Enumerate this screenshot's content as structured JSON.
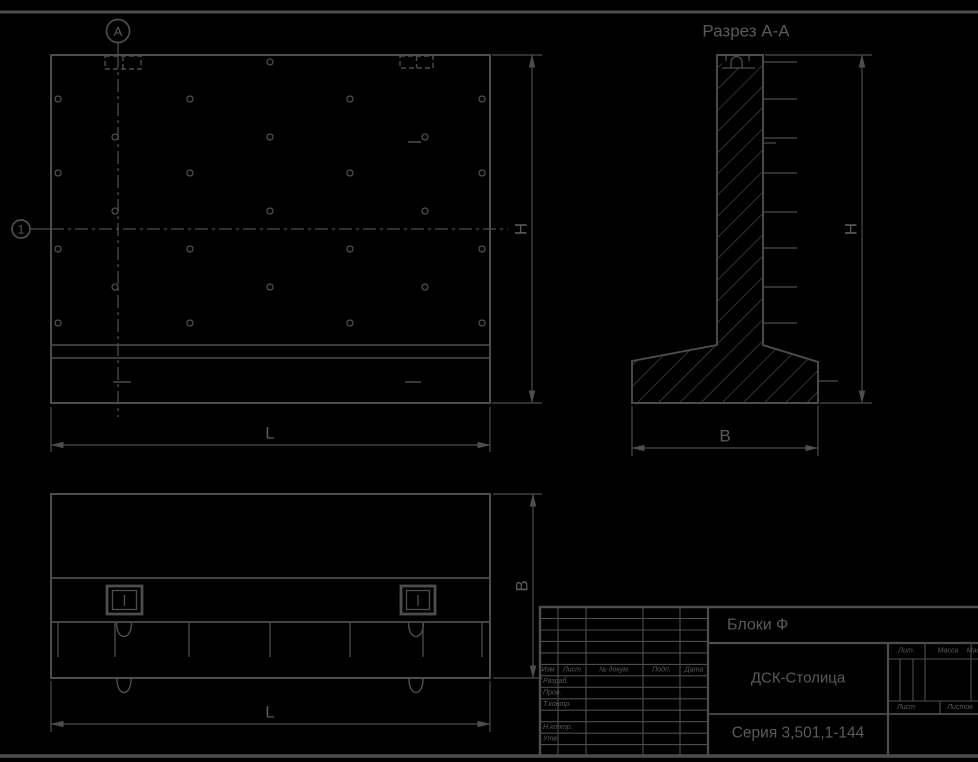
{
  "colors": {
    "background": "#000000",
    "line": "#4d4d4d",
    "text": "#5a5a5a"
  },
  "views": {
    "front": {
      "axis_marker_top": "А",
      "axis_marker_left": "1",
      "dim_length": "L",
      "dim_height": "H"
    },
    "section": {
      "title": "Разрез А-А",
      "dim_height": "H",
      "dim_width": "B"
    },
    "plan": {
      "dim_length": "L",
      "dim_width": "B"
    }
  },
  "title_block": {
    "doc_title": "Блоки Ф",
    "organization": "ДСК-Столица",
    "series": "Серия 3,501,1-144",
    "header_cols": [
      "Изм.",
      "Лист",
      "№ докум.",
      "Подп.",
      "Дата"
    ],
    "row_labels": [
      "Разраб.",
      "Пров.",
      "Т.контр.",
      "Н.контр.",
      "Утв."
    ],
    "right_headers": [
      "Лит.",
      "Масса",
      "Масштаб"
    ],
    "sheet_labels": [
      "Лист",
      "Листов"
    ]
  }
}
